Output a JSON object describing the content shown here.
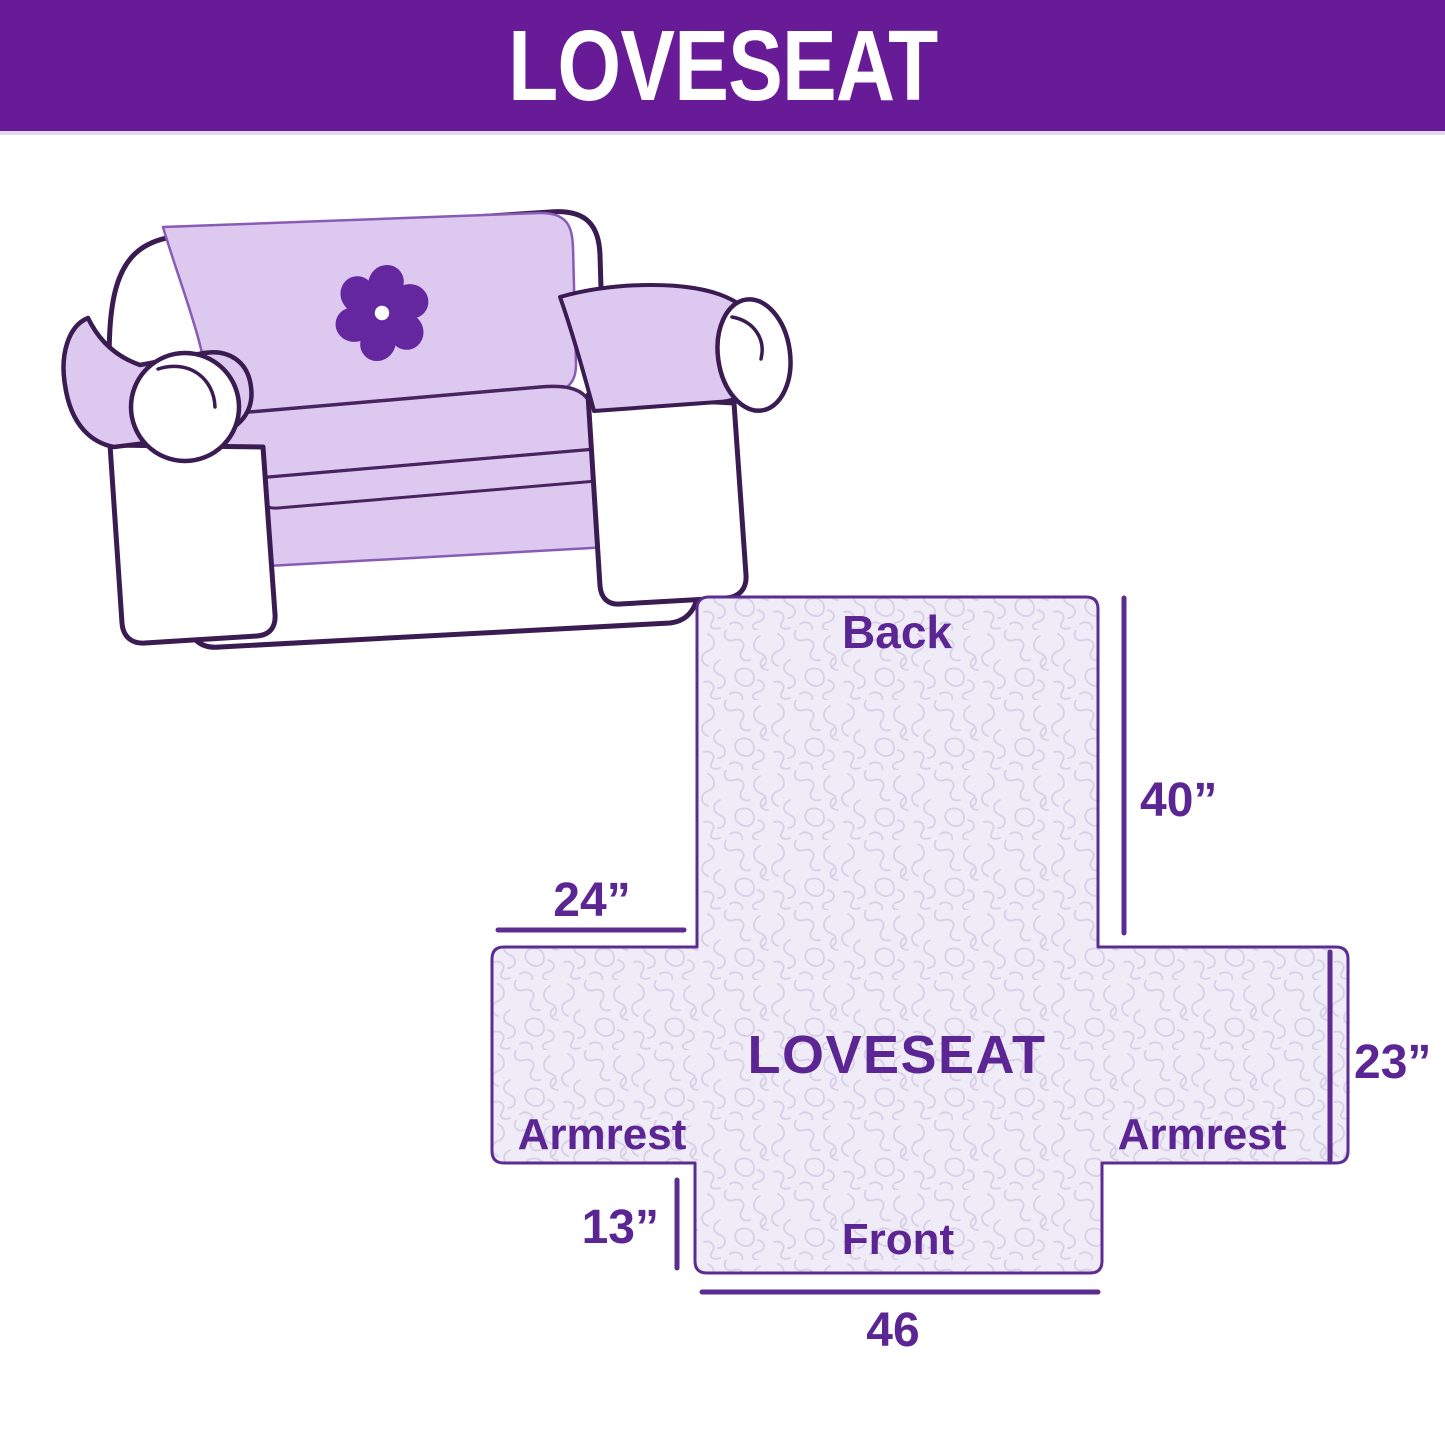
{
  "header": {
    "title": "LOVESEAT"
  },
  "illustration": {
    "description": "Line drawing of a loveseat sofa fitted with a light purple quilted protector cover",
    "logo_icon": "pinwheel-flower"
  },
  "diagram": {
    "center_label": "LOVESEAT",
    "back_label": "Back",
    "front_label": "Front",
    "armrest_left_label": "Armrest",
    "armrest_right_label": "Armrest",
    "dim_back_height": "40”",
    "dim_armrest_width": "24”",
    "dim_side_depth": "23”",
    "dim_front_drop": "13”",
    "dim_front_width": "46"
  },
  "colors": {
    "header_bg": "#681B97",
    "header_text": "#FFFFFF",
    "label_text": "#5B2693",
    "diagram_border": "#5C2D91",
    "diagram_fill": "#EFEBF7",
    "pattern_line": "#D9D0E7",
    "cover_fill": "#DDC9EF",
    "sofa_outline": "#3A1C52",
    "logo_purple": "#6527A0"
  }
}
